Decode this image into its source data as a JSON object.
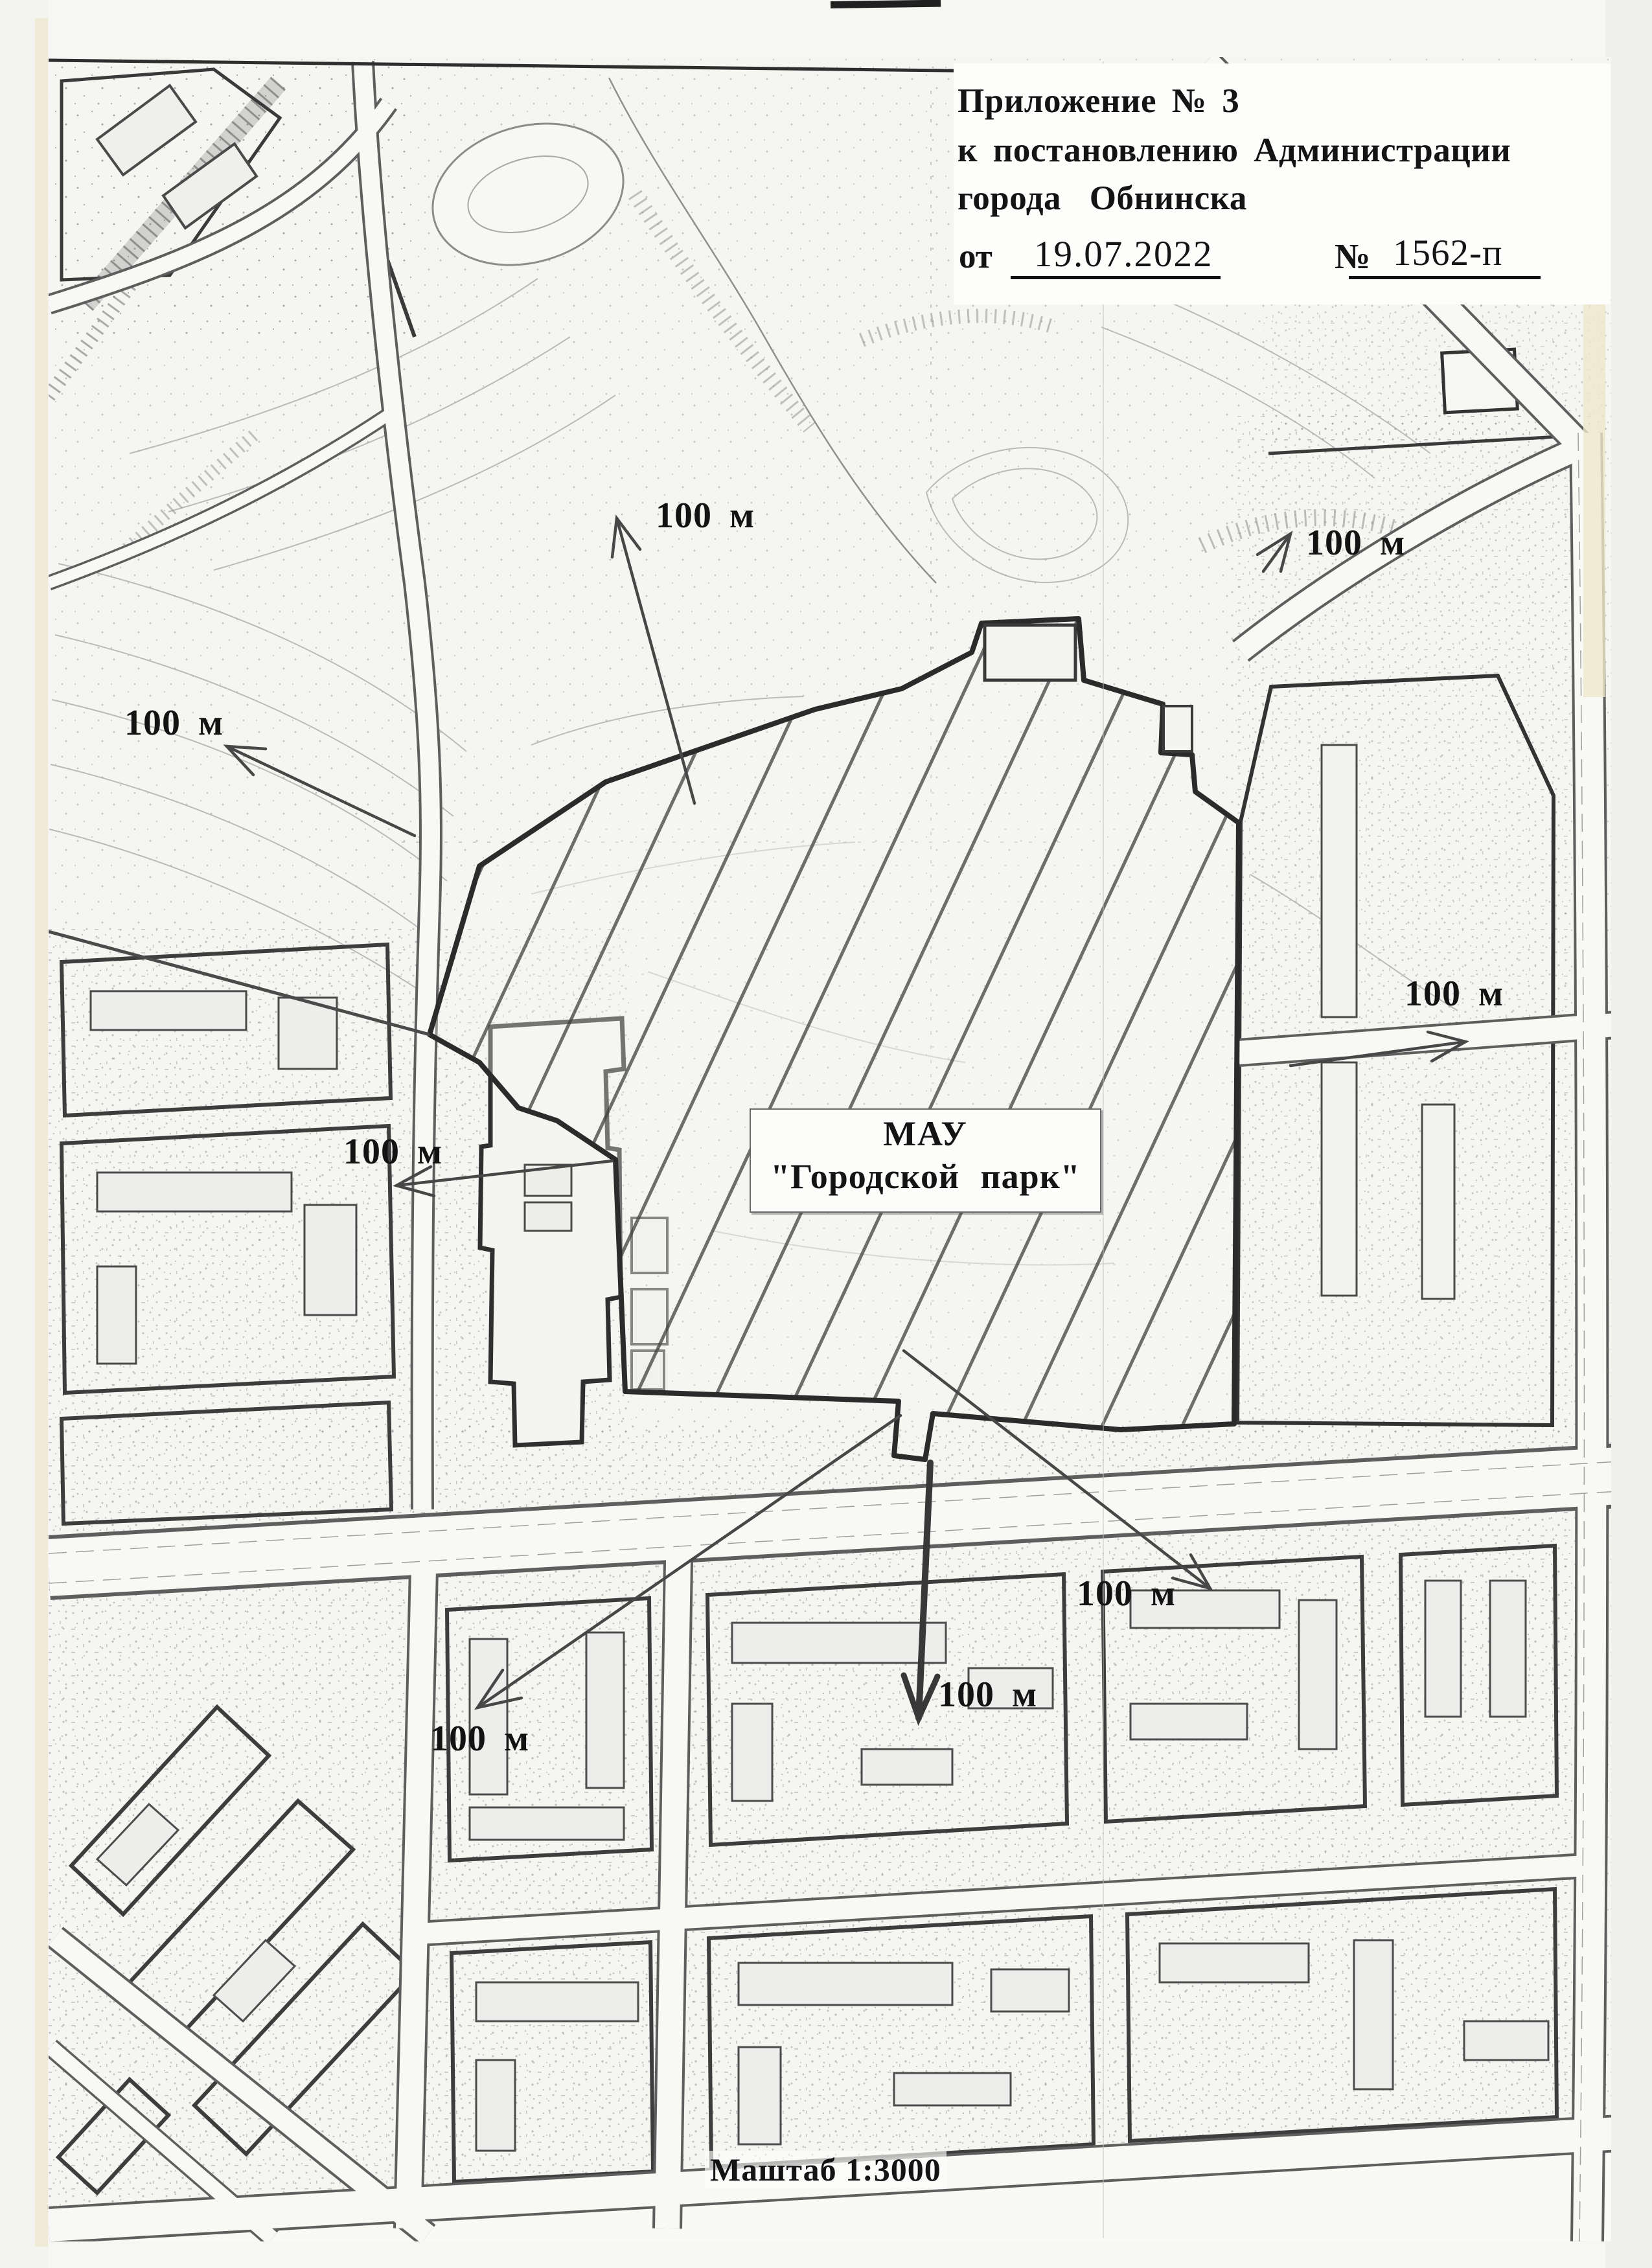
{
  "page": {
    "header": {
      "line1": "Приложение № 3",
      "line2": "к постановлению Администрации",
      "line3": "города Обнинска",
      "from_label": "от",
      "date": "19.07.2022",
      "number_label": "№",
      "number_value": "1562-п"
    },
    "map": {
      "park_label_line1": "МАУ",
      "park_label_line2": "\"Городской  парк\"",
      "scale_label": "Маштаб 1:3000",
      "distance_labels": [
        {
          "id": "north",
          "text": "100 м"
        },
        {
          "id": "north-east",
          "text": "100 м"
        },
        {
          "id": "west",
          "text": "100 м"
        },
        {
          "id": "east",
          "text": "100 м"
        },
        {
          "id": "mid-west",
          "text": "100 м"
        },
        {
          "id": "south-east",
          "text": "100 м"
        },
        {
          "id": "south",
          "text": "100 м"
        },
        {
          "id": "south-west",
          "text": "100 м"
        }
      ]
    }
  }
}
